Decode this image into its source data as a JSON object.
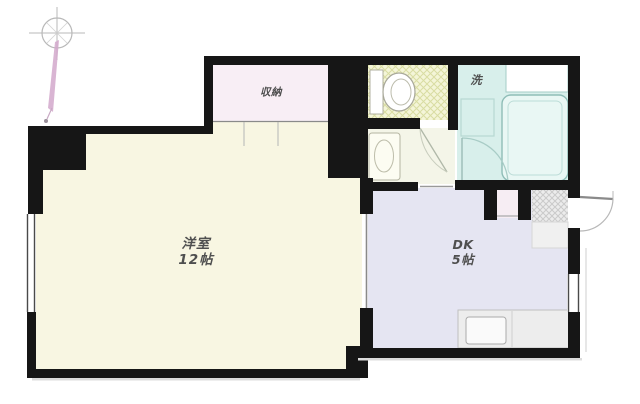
{
  "floor_plan": {
    "type": "apartment-floor-plan",
    "orientation_icon": "compass-rose-icon",
    "colors": {
      "wall": "#161616",
      "living_fill": "#f8f6e2",
      "dk_fill": "#e5e5f2",
      "bath_fill": "#d8efeb",
      "toilet_fill": "#f4f5d8",
      "closet_fill": "#f8eef5",
      "washroom_fill": "#f4f5e8",
      "entrance_fill": "#ececec",
      "compass_needle": "#d2a8cb"
    },
    "rooms": [
      {
        "id": "living-room",
        "label_line1": "洋室",
        "label_line2": "12帖"
      },
      {
        "id": "dining-kitchen",
        "label_line1": "DK",
        "label_line2": "5帖"
      },
      {
        "id": "closet",
        "label_line1": "収納",
        "label_line2": ""
      },
      {
        "id": "laundry",
        "label_line1": "洗",
        "label_line2": ""
      }
    ]
  }
}
